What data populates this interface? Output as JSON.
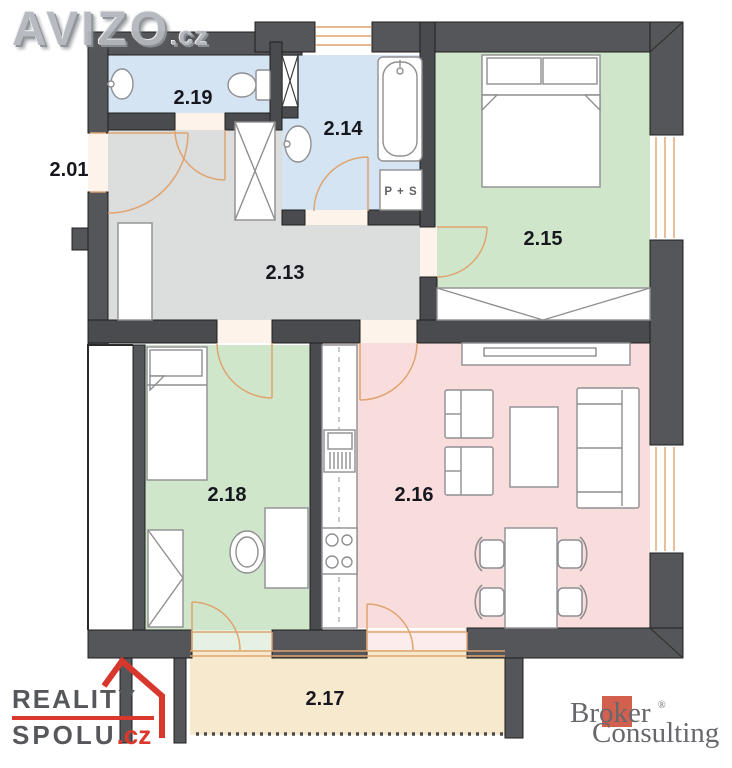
{
  "watermark": {
    "brand": "AVIZO",
    "tld": ".cz"
  },
  "plan": {
    "room_labels": {
      "entrance": "2.01",
      "hallway": "2.13",
      "bathroom": "2.14",
      "bedroom": "2.15",
      "living_room": "2.16",
      "balcony": "2.17",
      "kids_room": "2.18",
      "wc": "2.19"
    },
    "appliance_label": "P + S",
    "colors": {
      "wall_ext": "#55565a",
      "wall_int": "#4a4b4e",
      "wc_bathroom": "#d5e4f3",
      "bedrooms": "#d0e6cb",
      "hallway": "#dcdddd",
      "living": "#f9dddd",
      "balcony": "#f6e9cd",
      "door_swing": "#dfa46f",
      "threshold": "#fdf3ea"
    }
  },
  "logos": {
    "reality_spolu": {
      "word1": "REALITY",
      "word2": "SPOLU",
      "tld": ".cz"
    },
    "broker": {
      "word1": "Broker",
      "word2": "Consulting",
      "registered": "®"
    }
  }
}
